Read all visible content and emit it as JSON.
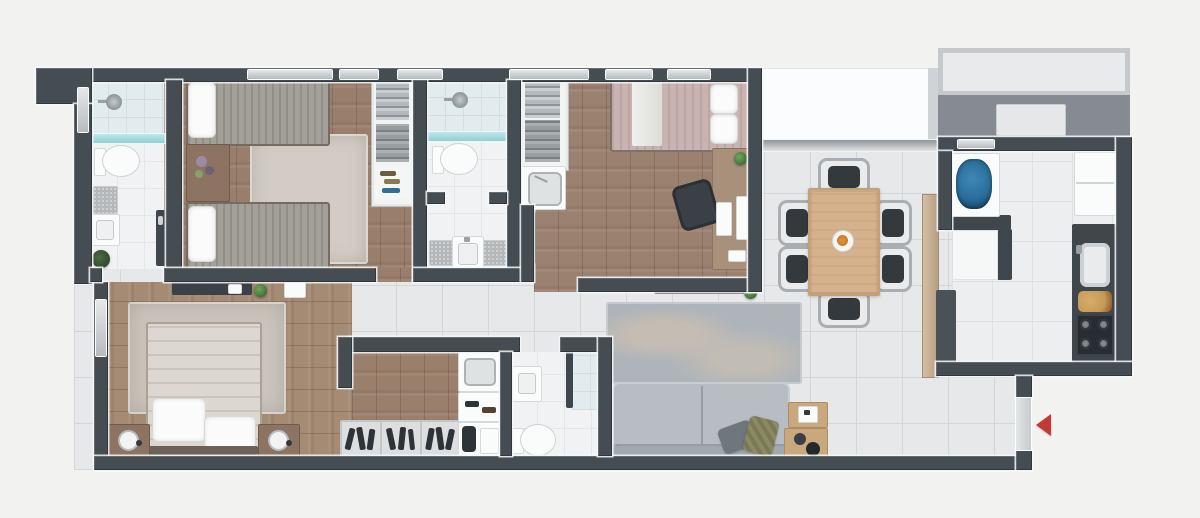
{
  "palette": {
    "bg": "#f2f3f1",
    "wall": "#454c52",
    "tile": "#e6e8e9",
    "tile-line": "#d2d6d8",
    "bath-tile": "#f0f2f3",
    "kitchen-tile": "#eceeef",
    "wood-bedroom1": "#997f6b",
    "wood-bedroom2": "#9b8170",
    "wood-master": "#a58a74",
    "wood-closet": "#9a7f6b",
    "window": "#c5c9cc",
    "glass-teal": "#8fcfd4",
    "terrace": "#fbfcfd",
    "tech-band": "#858b90",
    "counter-dark": "#3f464c",
    "counter-wood": "#c6ae93",
    "cabinet-white": "#f6f7f7",
    "sofa": "#b7bdc3",
    "rug-living": "#aeb4b9",
    "rug-beige": "#d2ccc4",
    "rug-master": "#cac4bd",
    "table-wood": "#d6b28c",
    "chair-gray": "#a9aeb2",
    "chair-dark": "#34393e",
    "bed-blanket": "#a39f99",
    "bed2-blanket": "#c9b3b0",
    "duvet": "#dcd8d1",
    "fixture-white": "#fafbfb",
    "appliance-blue": "#2a6e9b",
    "stove-dark": "#282d33",
    "plant-green": "#4c7f3f",
    "plant-dark": "#2f4a2c",
    "accent-red": "#c23a32",
    "wood-furn": "#8d7361",
    "desk-wood": "#a8907a",
    "pillow-dark": "#6f767c",
    "pillow-olive": "#8b8a64",
    "shoe-shelf": "#dcdedf",
    "mat-gray": "#b4b8bb",
    "centerpiece-orange": "#cc7a28"
  },
  "plan": {
    "type": "apartment-floor-plan",
    "view": "top-down-3d-render",
    "rooms": [
      {
        "id": "bathroom-1",
        "floor": "white-tile",
        "features": [
          "shower",
          "glass-partition",
          "toilet",
          "sink",
          "bath-mat",
          "plant",
          "door"
        ]
      },
      {
        "id": "bedroom-1",
        "floor": "wood",
        "features": [
          "twin-bed",
          "twin-bed",
          "nightstand-with-flowers",
          "area-rug",
          "wardrobe-clothes-shoes",
          "window"
        ]
      },
      {
        "id": "bathroom-2",
        "floor": "white-tile",
        "features": [
          "shower",
          "glass-partition",
          "toilet",
          "vanity-sink",
          "two-bath-mats"
        ]
      },
      {
        "id": "laundry-wardrobe",
        "floor": "wood",
        "features": [
          "wardrobe-with-clothes",
          "utility-sink"
        ]
      },
      {
        "id": "bedroom-2",
        "floor": "wood",
        "features": [
          "double-bed",
          "desk",
          "desk-chair",
          "plant",
          "papers",
          "window"
        ]
      },
      {
        "id": "hallway",
        "floor": "tile",
        "features": []
      },
      {
        "id": "master-bedroom",
        "floor": "wood",
        "features": [
          "double-bed",
          "two-nightstands",
          "two-lamps",
          "area-rug",
          "tv-console",
          "plant",
          "dresser"
        ]
      },
      {
        "id": "walk-in-closet",
        "floor": "wood",
        "features": [
          "shoe-racks",
          "cabinet-with-sink",
          "shoe-shelf",
          "storage"
        ]
      },
      {
        "id": "bathroom-3",
        "floor": "white-tile",
        "features": [
          "sink",
          "toilet",
          "shower-glass-partition"
        ]
      },
      {
        "id": "living-room",
        "floor": "tile",
        "features": [
          "sofa",
          "throw-pillow-dark",
          "throw-pillow-olive",
          "area-rug",
          "tv-console",
          "plant",
          "side-tables",
          "decor-objects"
        ]
      },
      {
        "id": "dining-room",
        "floor": "tile",
        "features": [
          "dining-table",
          "six-chairs",
          "centerpiece-with-fruit",
          "wood-panel",
          "dark-counter"
        ]
      },
      {
        "id": "kitchen",
        "floor": "tile",
        "features": [
          "counter-sink-with-blue-dishes",
          "refrigerator",
          "white-cabinet",
          "dark-counter",
          "kitchen-sink",
          "cutting-board-with-food",
          "cooktop"
        ]
      },
      {
        "id": "terrace",
        "floor": "white",
        "features": [
          "glass-rail"
        ]
      },
      {
        "id": "service-area",
        "floor": "concrete",
        "features": [
          "ac-unit",
          "planter-frame"
        ]
      }
    ],
    "entrance": {
      "marker": "red-arrow",
      "direction": "left",
      "location": "right-wall-near-living-room"
    }
  }
}
